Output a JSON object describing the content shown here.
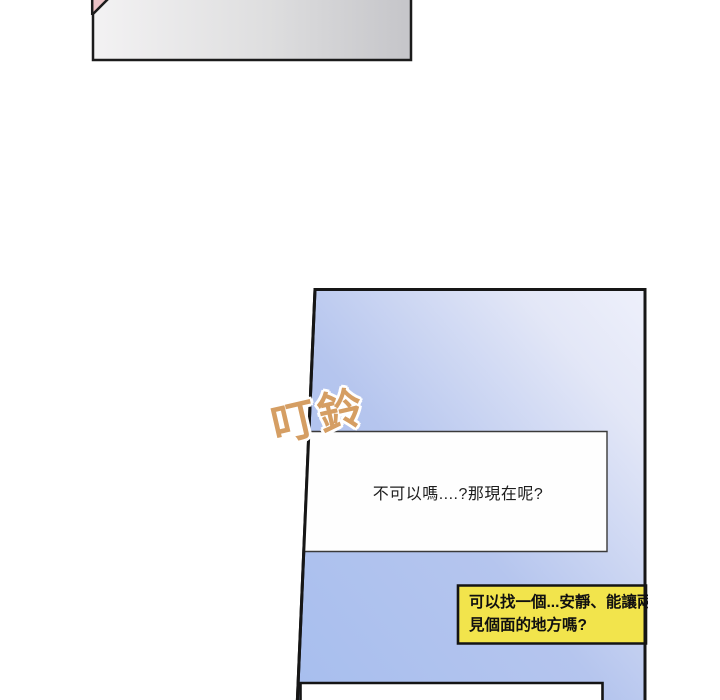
{
  "page": {
    "background": "#ffffff"
  },
  "shapes": {
    "top_box": {
      "fill_left": "#f3f2f3",
      "fill_mid": "#dededf",
      "fill_right": "#c5c5c9",
      "border": "#1b1b1b",
      "corner_accent": "#ecc3c7"
    },
    "panel": {
      "fill_dark": "#a7beee",
      "fill_mid": "#b5c5ee",
      "fill_light": "#e3e7f7",
      "fill_lightest": "#eef0fb",
      "border": "#161616"
    }
  },
  "sfx": {
    "text": "叮鈴",
    "color": "#d59e63"
  },
  "bubbles": {
    "white": {
      "text": "不可以嗎....?那現在呢?",
      "fill": "#fefefe",
      "border": "#3a3a3a",
      "text_color": "#1d1d1d"
    },
    "yellow": {
      "line1": "可以找一個...安靜、能讓兩",
      "line2": "見個面的地方嗎?",
      "fill": "#f2e44c",
      "border": "#141414",
      "text_color": "#101010"
    },
    "bottom": {
      "fill": "#ffffff",
      "border": "#141414"
    }
  }
}
